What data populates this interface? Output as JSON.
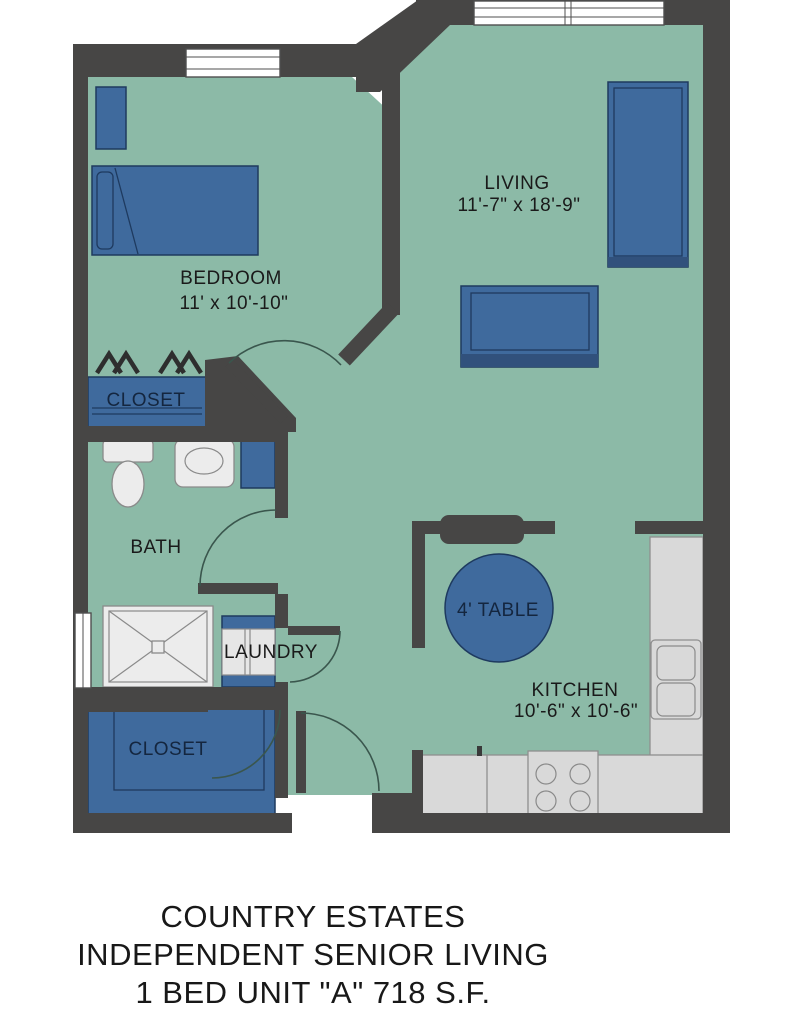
{
  "floor_plan": {
    "title": {
      "line1": "COUNTRY ESTATES",
      "line2": "INDEPENDENT SENIOR LIVING",
      "line3": "1 BED UNIT \"A\" 718 S.F."
    },
    "rooms": {
      "bedroom": {
        "label": "BEDROOM",
        "dims": "11' x 10'-10\""
      },
      "living": {
        "label": "LIVING",
        "dims": "11'-7\" x 18'-9\""
      },
      "kitchen": {
        "label": "KITCHEN",
        "dims": "10'-6\" x 10'-6\""
      },
      "bath": {
        "label": "BATH"
      },
      "laundry": {
        "label": "LAUNDRY"
      },
      "bedroom_closet": {
        "label": "CLOSET"
      },
      "entry_closet": {
        "label": "CLOSET"
      },
      "dining_table": {
        "label": "4' TABLE"
      }
    },
    "colors": {
      "floor": "#8cbaa7",
      "wall": "#474645",
      "furniture": "#3f6a9d",
      "furniture-outline": "#1e3a5f",
      "furniture-shade": "#31517c",
      "counter": "#d9d9d9",
      "counter-outline": "#8f8f8f",
      "fixture": "#ececec",
      "fixture-outline": "#8a8a8a",
      "door-arc": "#3a564d",
      "label": "#1a1a1a",
      "closet-label": "#14263f"
    }
  }
}
